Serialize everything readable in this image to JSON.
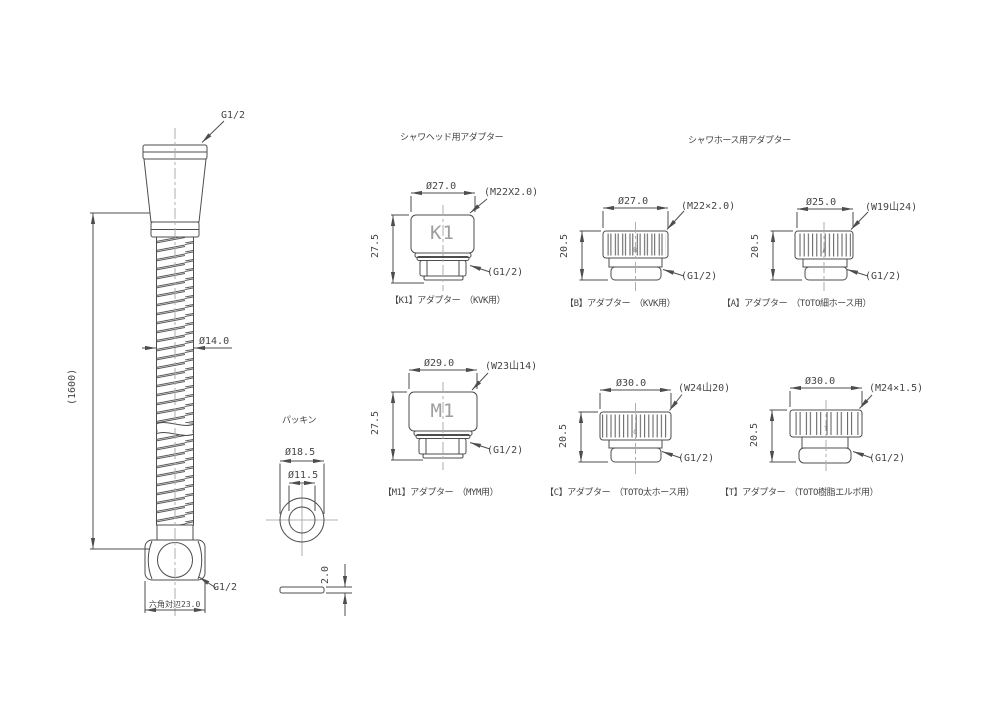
{
  "titles": {
    "shower_head_adapter": "シャワヘッド用アダプター",
    "shower_hose_adapter": "シャワホース用アダプター",
    "packing": "パッキン"
  },
  "hose": {
    "top_thread": "G1/2",
    "outer_dia": "Ø14.0",
    "length": "(1600)",
    "bottom_thread": "G1/2",
    "hex_flats": "六角対辺23.0"
  },
  "packing": {
    "outer_dia": "Ø18.5",
    "inner_dia": "Ø11.5",
    "thickness": "2.0"
  },
  "adapters": {
    "k1": {
      "label": "K1",
      "dia": "Ø27.0",
      "height": "27.5",
      "thread": "(M22X2.0)",
      "outlet": "(G1/2)",
      "caption": "【K1】アダプター　（KVK用）"
    },
    "b": {
      "label": "B",
      "dia": "Ø27.0",
      "height": "20.5",
      "thread": "(M22×2.0)",
      "outlet": "(G1/2)",
      "caption": "【B】アダプター　（KVK用）"
    },
    "a": {
      "label": "A",
      "dia": "Ø25.0",
      "height": "20.5",
      "thread": "(W19山24)",
      "outlet": "(G1/2)",
      "caption": "【A】アダプター　（TOTO細ホース用）"
    },
    "m1": {
      "label": "M1",
      "dia": "Ø29.0",
      "height": "27.5",
      "thread": "(W23山14)",
      "outlet": "(G1/2)",
      "caption": "【M1】アダプター　（MYM用）"
    },
    "c": {
      "label": "C",
      "dia": "Ø30.0",
      "height": "20.5",
      "thread": "(W24山20)",
      "outlet": "(G1/2)",
      "caption": "【C】アダプター　（TOTO太ホース用）"
    },
    "t": {
      "label": "T",
      "dia": "Ø30.0",
      "height": "20.5",
      "thread": "(M24×1.5)",
      "outlet": "(G1/2)",
      "caption": "【T】アダプター　（TOTO樹脂エルボ用）"
    }
  },
  "colors": {
    "line": "#4d4d4d",
    "text": "#454545",
    "centerline": "#aeaeae",
    "background": "#ffffff"
  }
}
